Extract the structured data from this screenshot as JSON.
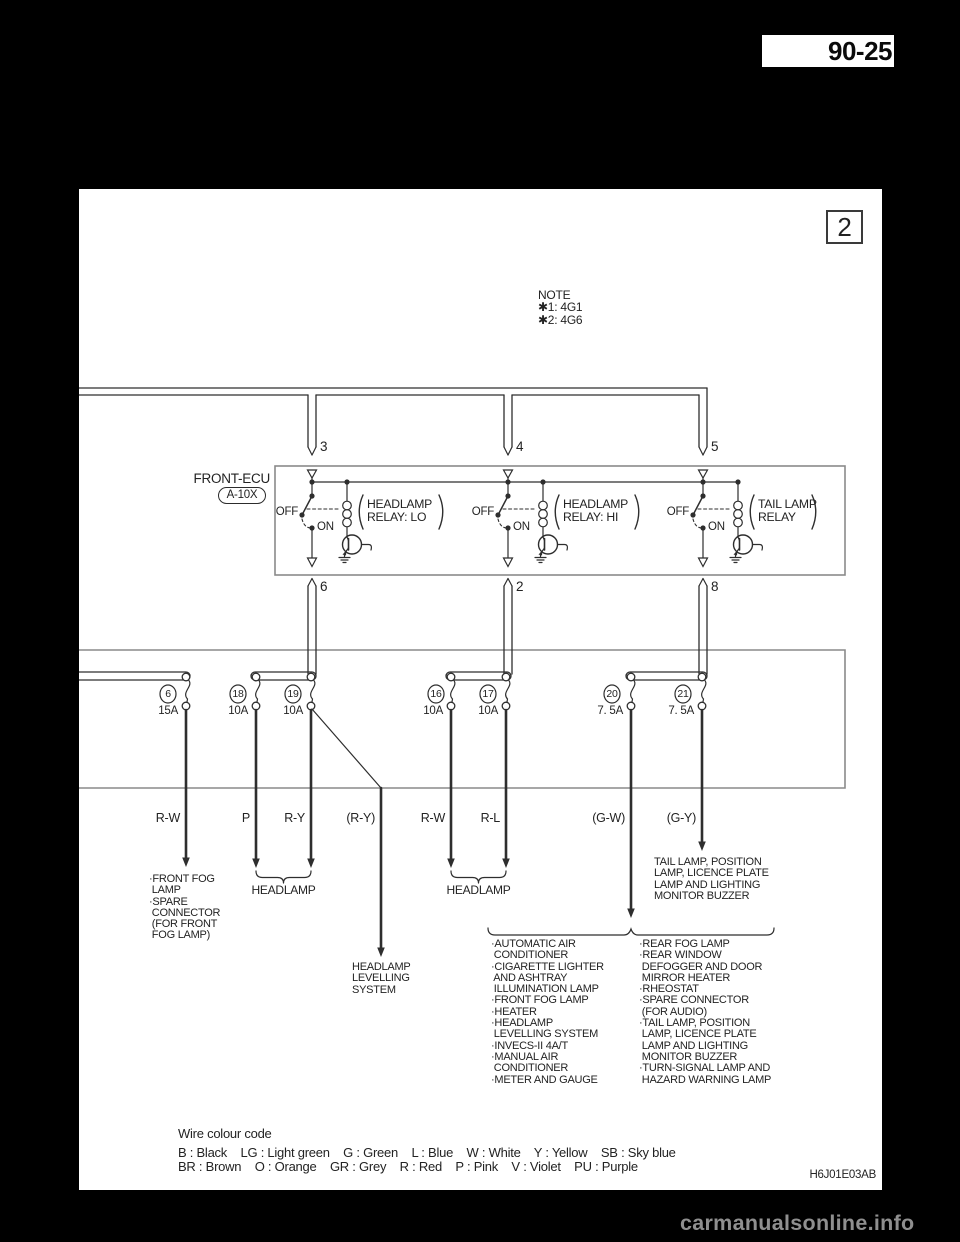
{
  "header": {
    "page_number": "90-25"
  },
  "figure": {
    "number": "2"
  },
  "note": {
    "title": "NOTE",
    "lines": [
      "✱1: 4G1",
      "✱2: 4G6"
    ]
  },
  "ecu": {
    "label": "FRONT-ECU",
    "connector": "A-10X",
    "relays": [
      {
        "top_pin": "3",
        "bottom_pin": "6",
        "off_label": "OFF",
        "on_label": "ON",
        "name_lines": [
          "HEADLAMP",
          "RELAY: LO"
        ]
      },
      {
        "top_pin": "4",
        "bottom_pin": "2",
        "off_label": "OFF",
        "on_label": "ON",
        "name_lines": [
          "HEADLAMP",
          "RELAY: HI"
        ]
      },
      {
        "top_pin": "5",
        "bottom_pin": "8",
        "off_label": "OFF",
        "on_label": "ON",
        "name_lines": [
          "TAIL LAMP",
          "RELAY"
        ]
      }
    ]
  },
  "fuses": [
    {
      "number": "6",
      "rating": "15A"
    },
    {
      "number": "18",
      "rating": "10A"
    },
    {
      "number": "19",
      "rating": "10A"
    },
    {
      "number": "16",
      "rating": "10A"
    },
    {
      "number": "17",
      "rating": "10A"
    },
    {
      "number": "20",
      "rating": "7. 5A"
    },
    {
      "number": "21",
      "rating": "7. 5A"
    }
  ],
  "wires": [
    {
      "label": "R-W"
    },
    {
      "label": "P"
    },
    {
      "label": "R-Y"
    },
    {
      "label": "(R-Y)"
    },
    {
      "label": "R-W"
    },
    {
      "label": "R-L"
    },
    {
      "label": "(G-W)"
    },
    {
      "label": "(G-Y)"
    }
  ],
  "destinations": {
    "front_fog_lines": [
      "·FRONT FOG",
      " LAMP",
      "·SPARE",
      " CONNECTOR",
      " (FOR FRONT",
      " FOG LAMP)"
    ],
    "headlamp_1": "HEADLAMP",
    "headlamp_2": "HEADLAMP",
    "levelling_lines": [
      "HEADLAMP",
      "LEVELLING",
      "SYSTEM"
    ],
    "tail_lines": [
      "TAIL LAMP, POSITION",
      "LAMP, LICENCE PLATE",
      "LAMP AND LIGHTING",
      "MONITOR BUZZER"
    ],
    "group_left_lines": [
      "·AUTOMATIC AIR",
      " CONDITIONER",
      "·CIGARETTE LIGHTER",
      " AND ASHTRAY",
      " ILLUMINATION LAMP",
      "·FRONT FOG LAMP",
      "·HEATER",
      "·HEADLAMP",
      " LEVELLING SYSTEM",
      "·INVECS-II 4A/T",
      "·MANUAL AIR",
      " CONDITIONER",
      "·METER AND GAUGE"
    ],
    "group_right_lines": [
      "·REAR FOG LAMP",
      "·REAR WINDOW",
      " DEFOGGER AND DOOR",
      " MIRROR HEATER",
      "·RHEOSTAT",
      "·SPARE CONNECTOR",
      " (FOR AUDIO)",
      "·TAIL LAMP, POSITION",
      " LAMP, LICENCE PLATE",
      " LAMP AND LIGHTING",
      " MONITOR BUZZER",
      "·TURN-SIGNAL LAMP AND",
      " HAZARD WARNING LAMP"
    ]
  },
  "legend": {
    "title": "Wire colour code",
    "row1": "B : Black    LG : Light green    G : Green    L : Blue    W : White    Y : Yellow    SB : Sky blue",
    "row2": "BR : Brown    O : Orange    GR : Grey    R : Red    P : Pink    V : Violet    PU : Purple"
  },
  "footer": {
    "diagram_code": "H6J01E03AB",
    "watermark": "carmanualsonline.info"
  },
  "colors": {
    "background": "#000000",
    "paper": "#ffffff",
    "line": "#2e2e2e",
    "box": "#8a8a8a",
    "watermark": "#8f8f8f"
  }
}
